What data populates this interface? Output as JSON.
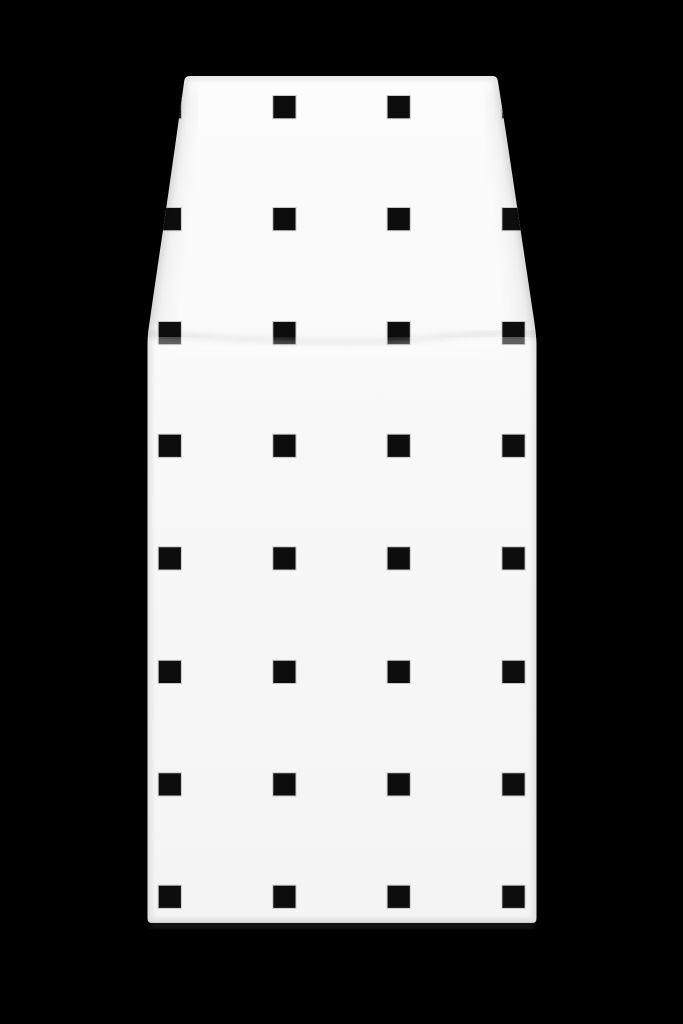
{
  "scene": {
    "description": "Studio product photograph of a white pencil-skirt style garment panel with an all-over grid pattern of small black squares, shot on a pure black background. Garment narrows toward the waist at top, flares to the hip, then hangs straight to the hem.",
    "background_color": "#000000",
    "object_name": "square-pattern-skirt"
  },
  "garment": {
    "base_color_top": "#fcfcfc",
    "base_color_bottom": "#f4f4f4",
    "edge_shade_color": "rgba(0,0,0,0.10)",
    "slant_shade_color": "rgba(0,0,0,0.05)",
    "fold_shadow_color": "rgba(0,0,0,0.07)",
    "fold_highlight_color": "#ffffff",
    "hem_y": 923,
    "waist_y": 76,
    "waist_left_x": 190,
    "waist_right_x": 493,
    "hip_left_x": 147.5,
    "hip_right_x": 536.5
  },
  "pattern": {
    "square_color": "#0d0d0d",
    "square_halo_color": "#c9c9c9",
    "square_size": 23.2,
    "cols_x": [
      158.2,
      272.8,
      387.1,
      501.9
    ],
    "rows_y": [
      95.5,
      207.5,
      321.5,
      434.2,
      546.8,
      660.3,
      772.8,
      885.2
    ],
    "columns": 4,
    "rows": 8,
    "total_squares": 32
  }
}
